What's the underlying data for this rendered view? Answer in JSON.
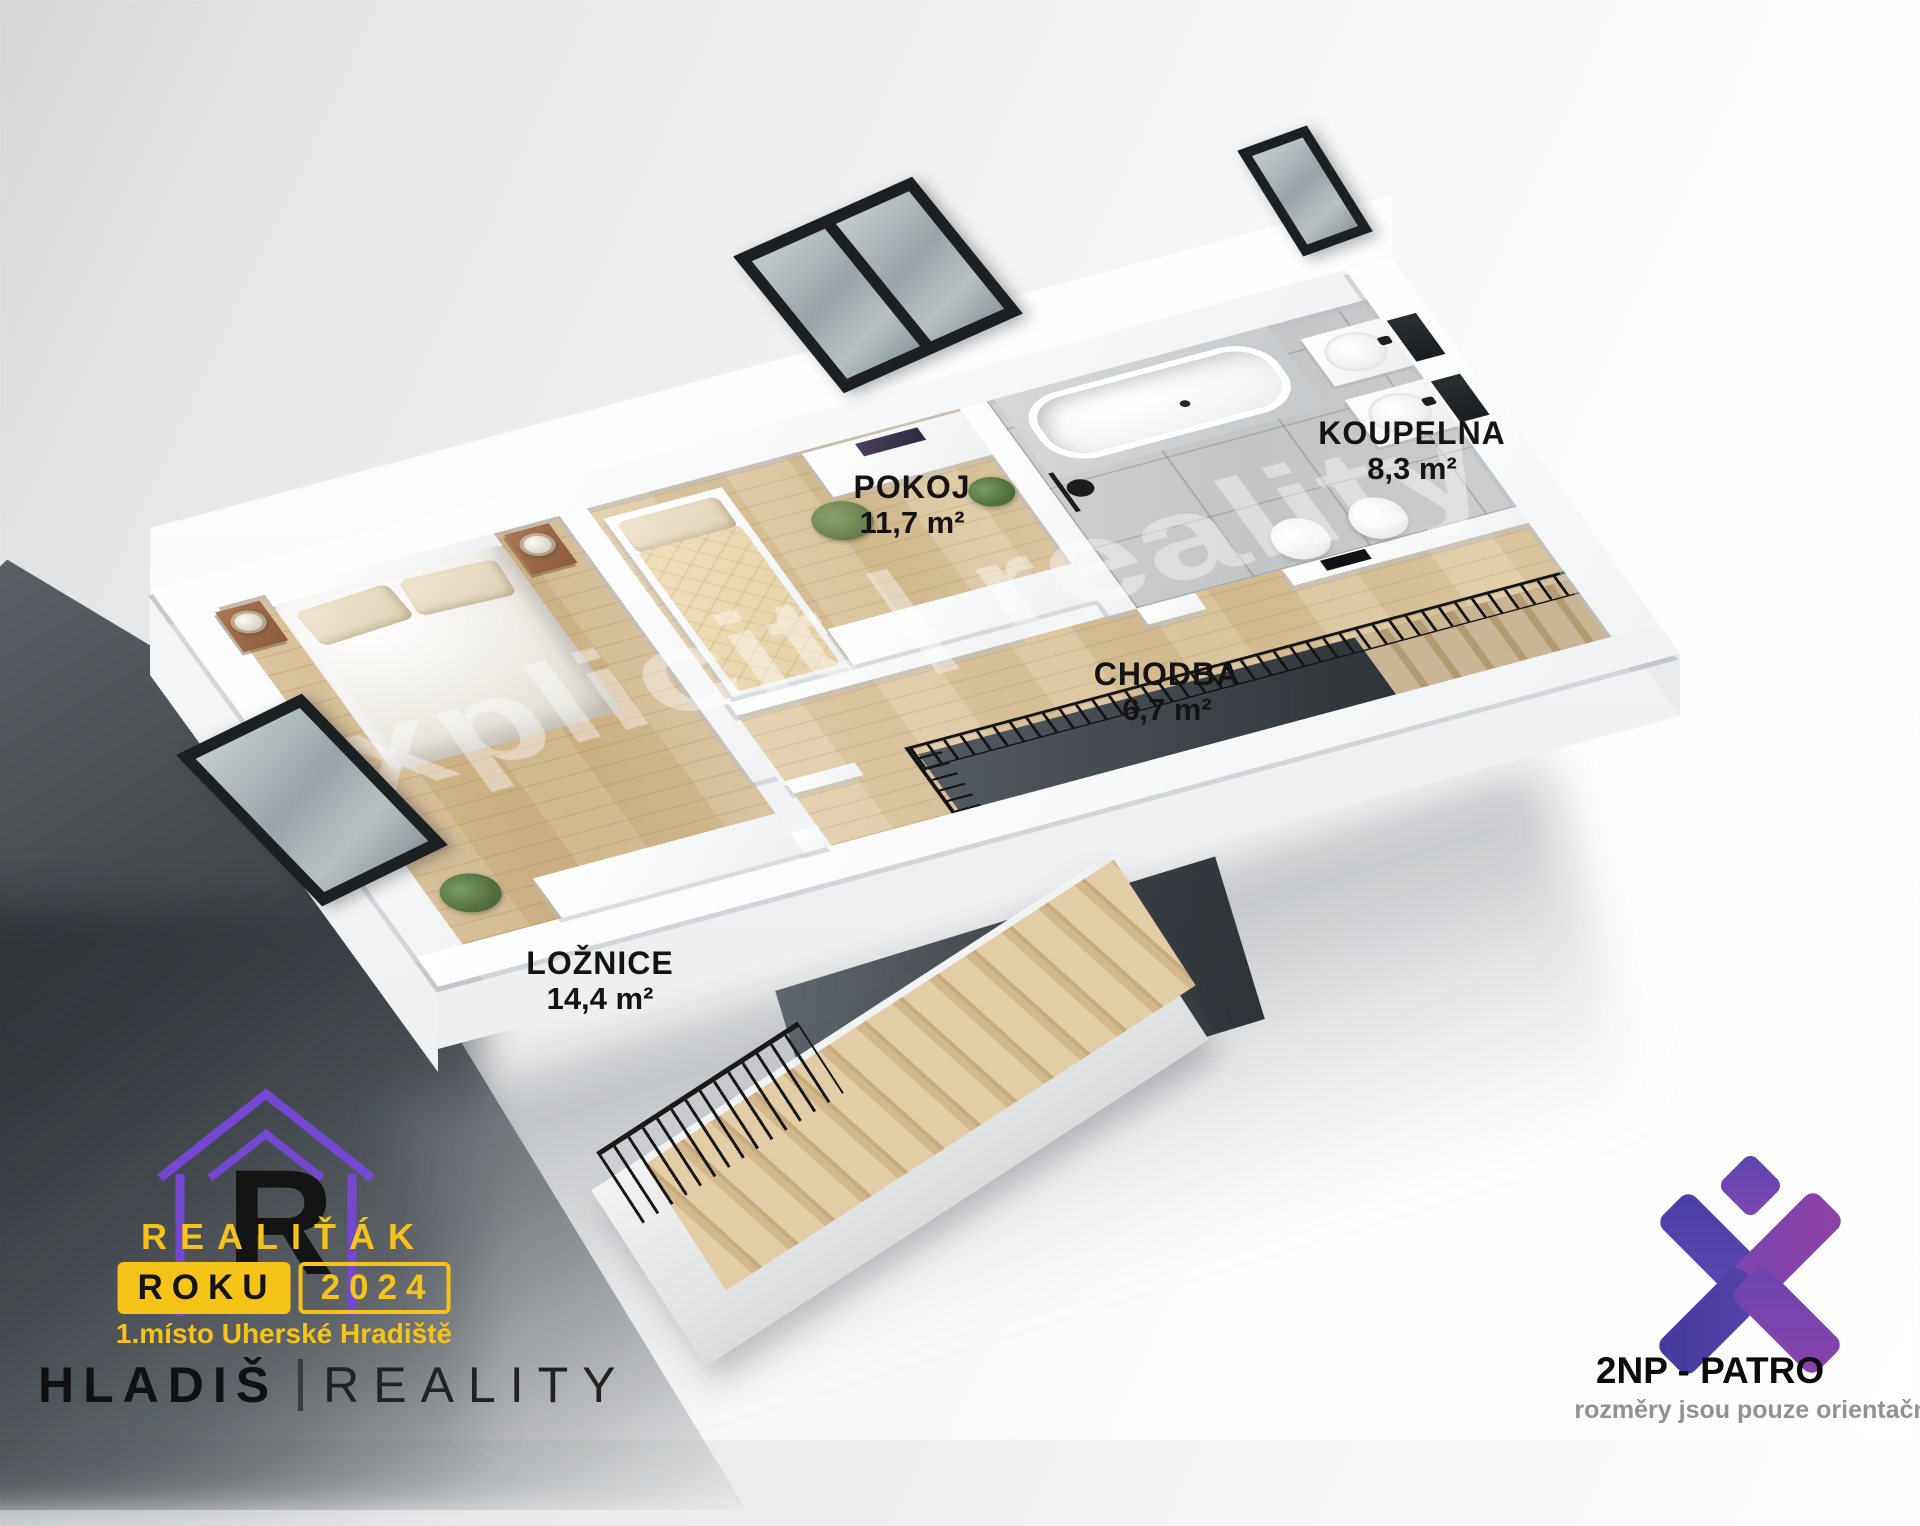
{
  "watermark": {
    "text": "xplicit | reality"
  },
  "rooms": [
    {
      "key": "pokoj",
      "label": "POKOJ",
      "area": "11,7 m²"
    },
    {
      "key": "koupelna",
      "label": "KOUPELNA",
      "area": "8,3 m²"
    },
    {
      "key": "chodba",
      "label": "CHODBA",
      "area": "6,7 m²"
    },
    {
      "key": "loznice",
      "label": "LOŽNICE",
      "area": "14,4 m²"
    }
  ],
  "award": {
    "title": "REALIŤÁK",
    "badge_left": "ROKU",
    "badge_right": "2024",
    "subtitle": "1.místo Uherské Hradiště",
    "monogram": "R"
  },
  "brand": {
    "name": "HLADIŠ",
    "divider": "",
    "suffix": "REALITY"
  },
  "floor": {
    "title": "2NP - PATRO",
    "disclaimer": "rozměry jsou pouze orientační"
  },
  "colors": {
    "award_yellow": "#f6c318",
    "logo_purple": "#7448d0",
    "x_indigo": "#4a3ea3",
    "x_purple": "#8a42ab",
    "wood": "#d7bd93",
    "tile": "#c7c9cb"
  }
}
